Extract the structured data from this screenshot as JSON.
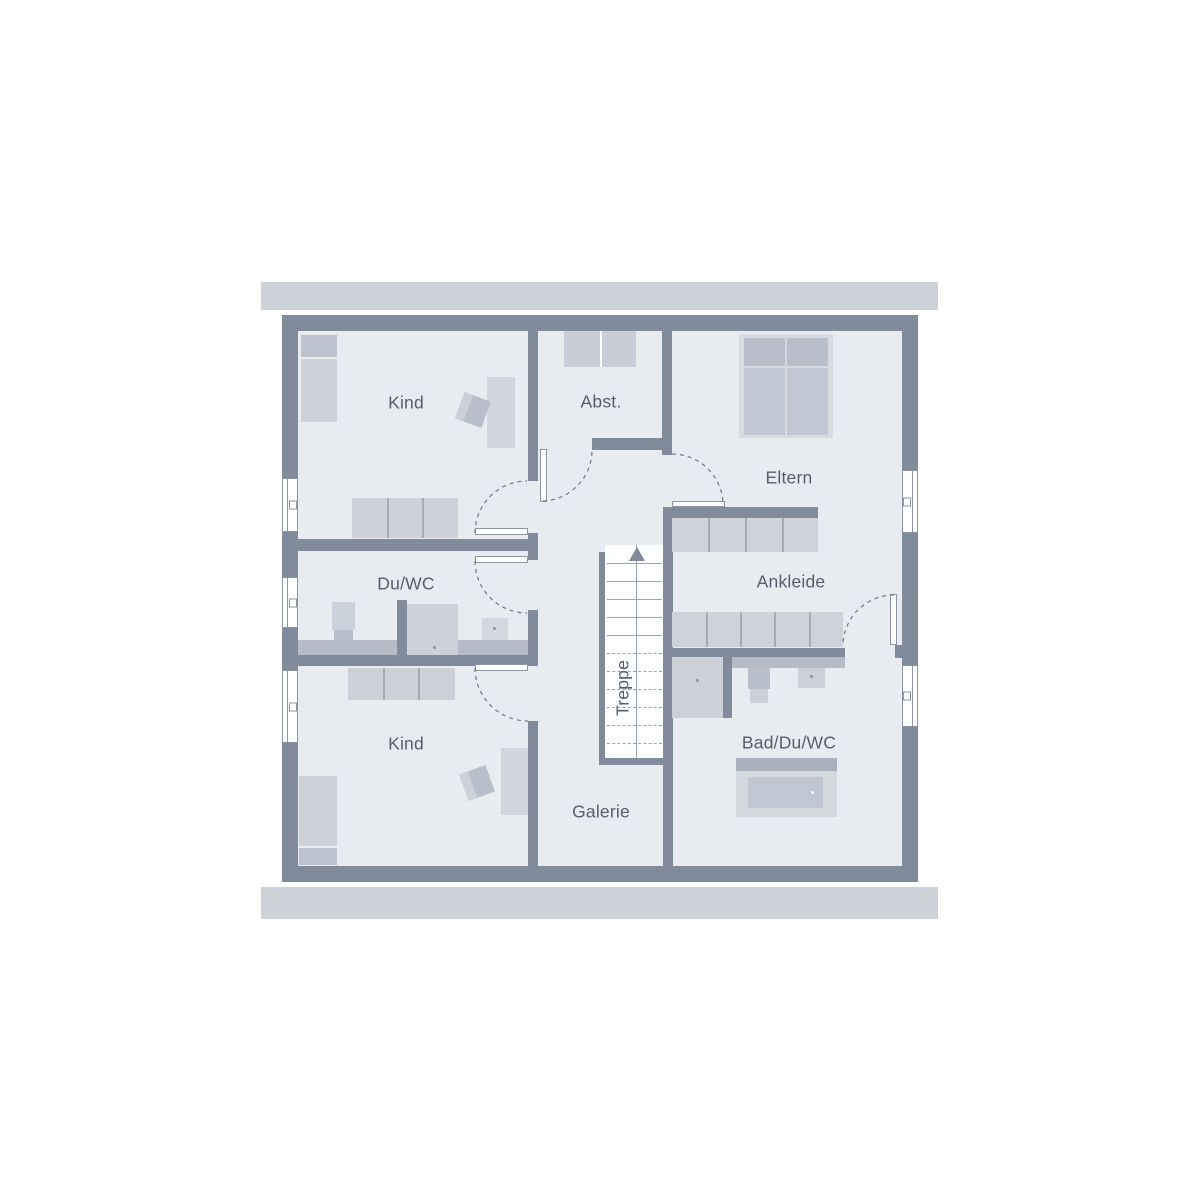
{
  "floorplan": {
    "title": "Obergeschoss Grundriss",
    "rooms": {
      "kind_top": {
        "label": "Kind"
      },
      "abstellraum": {
        "label": "Abst."
      },
      "eltern": {
        "label": "Eltern"
      },
      "du_wc": {
        "label": "Du/WC"
      },
      "ankleide": {
        "label": "Ankleide"
      },
      "kind_bottom": {
        "label": "Kind"
      },
      "bad_du_wc": {
        "label": "Bad/Du/WC"
      },
      "galerie": {
        "label": "Galerie"
      },
      "treppe": {
        "label": "Treppe"
      }
    },
    "colors": {
      "wall": "#808b9b",
      "floor": "#e8ebf0",
      "band": "#cdd1d8",
      "frame": "#8b95a3",
      "label": "#555f6c",
      "arc": "#6e7988",
      "furn_light": "#ccd1d9",
      "furn_medium": "#b8bfcb",
      "counter": "#b5bcc8",
      "bed_frame": "#d7dbe1",
      "tub_header": "#a8b0bd",
      "tub_inner": "#c1c7d2"
    }
  }
}
